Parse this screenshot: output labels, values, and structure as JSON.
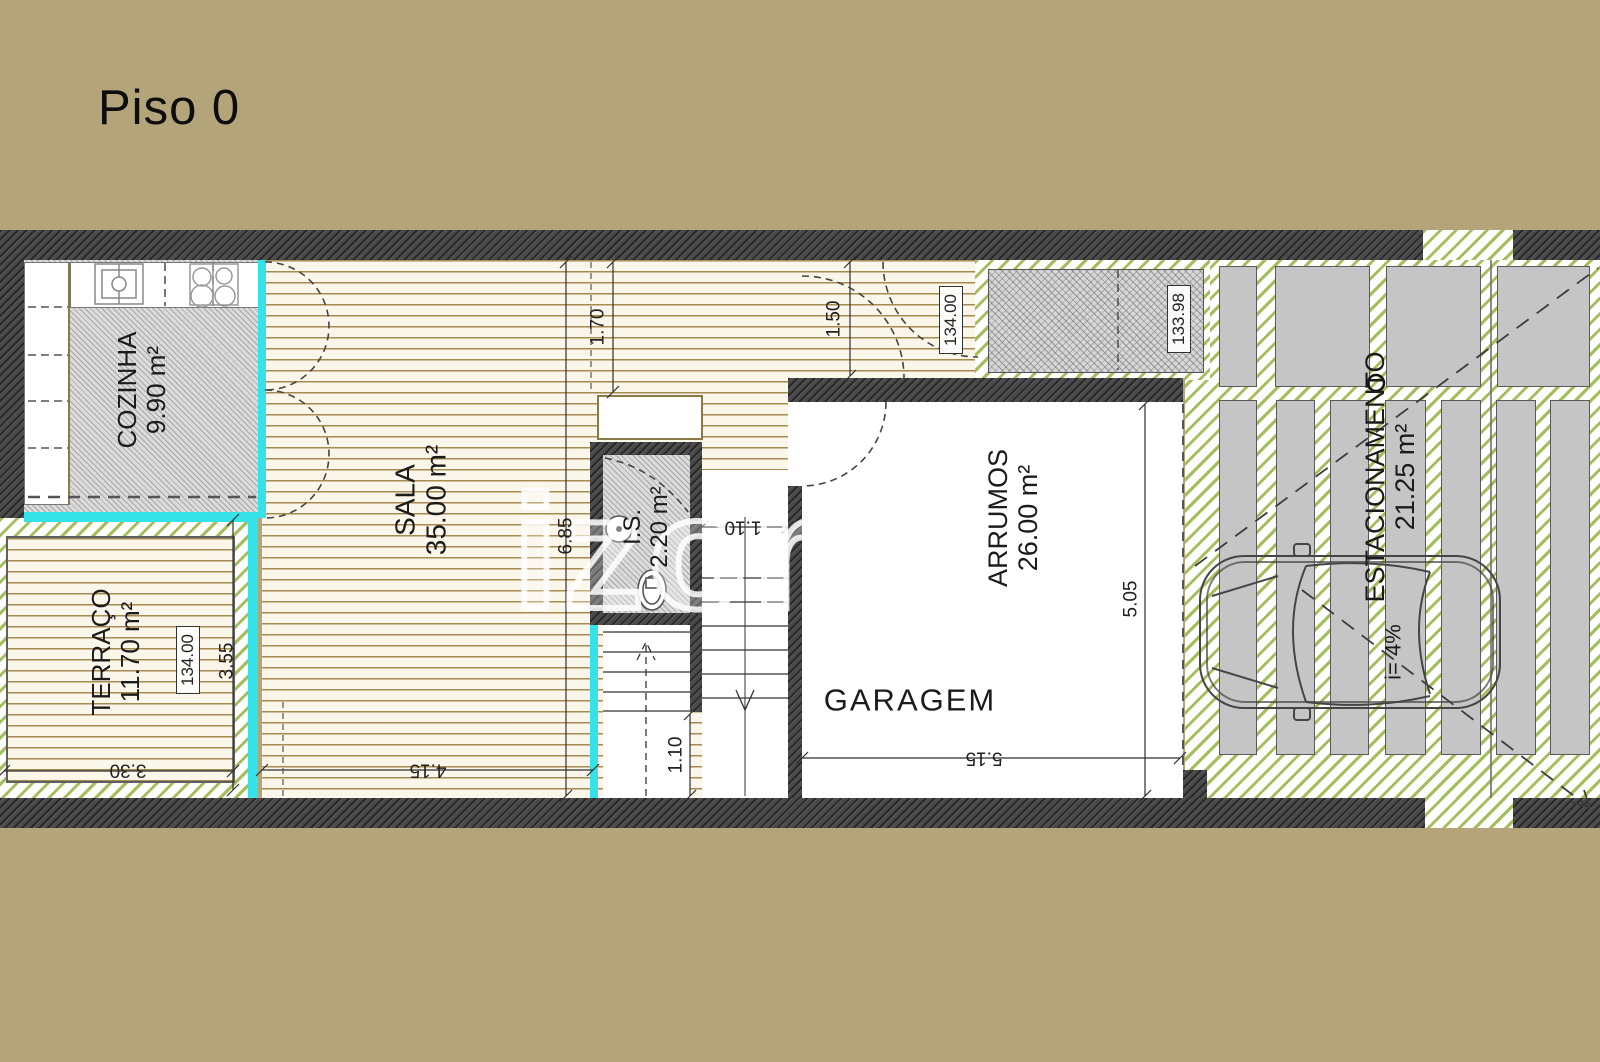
{
  "page": {
    "title": "Piso 0"
  },
  "watermark": {
    "text": "izome",
    "registered": "®"
  },
  "rooms": {
    "cozinha": {
      "name": "COZINHA",
      "area": "9.90 m²"
    },
    "sala": {
      "name": "SALA",
      "area": "35.00 m²"
    },
    "terraco": {
      "name": "TERRAÇO",
      "area": "11.70 m²"
    },
    "instalacao_sanitaria": {
      "name": "I.S.",
      "area": "2.20 m²"
    },
    "arrumos": {
      "name": "ARRUMOS",
      "area": "26.00 m²"
    },
    "garagem": {
      "name": "GARAGEM"
    },
    "estacionamento": {
      "name": "ESTACIONAMENTO",
      "area": "21.25 m²",
      "slope": "i= 4%"
    }
  },
  "dimensions": {
    "entry_depth": "1.70",
    "corridor_depth": "1.50",
    "sala_height": "6.85",
    "sala_width": "4.15",
    "terraco_height": "3.55",
    "terraco_width": "3.30",
    "stair_width": "1.10",
    "stair_landing": "1.10",
    "garagem_width": "5.15",
    "garagem_height": "5.05"
  },
  "levels": {
    "hall": "134.00",
    "terraco": "134.00",
    "ramp": "133.98"
  },
  "colors": {
    "background": "#b3a479",
    "wall": "#4a4a4a",
    "glass_cyan": "#35e2e8",
    "green_hatch": "#a3bf5c",
    "wood_line": "#a98f55",
    "paver_gray": "#c5c5c5"
  }
}
